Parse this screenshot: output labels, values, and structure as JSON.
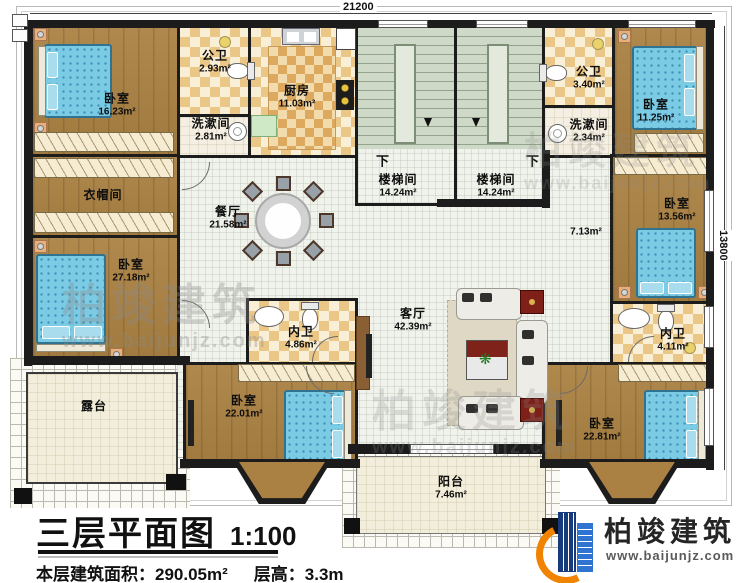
{
  "dimensions": {
    "top": "21200",
    "right": "13800"
  },
  "rooms": {
    "bedroom_tl": {
      "name": "卧室",
      "area": "16.23m²"
    },
    "pub_bath_l": {
      "name": "公卫",
      "area": "2.93m²"
    },
    "wash_l": {
      "name": "洗漱间",
      "area": "2.81m²"
    },
    "kitchen": {
      "name": "厨房",
      "area": "11.03m²"
    },
    "stair_l": {
      "name": "楼梯间",
      "area": "14.24m²",
      "down": "下"
    },
    "stair_r": {
      "name": "楼梯间",
      "area": "14.24m²",
      "down": "下"
    },
    "pub_bath_r": {
      "name": "公卫",
      "area": "3.40m²"
    },
    "wash_r": {
      "name": "洗漱间",
      "area": "2.34m²"
    },
    "bedroom_tr": {
      "name": "卧室",
      "area": "11.25m²"
    },
    "cloakroom": {
      "name": "衣帽间"
    },
    "dining": {
      "name": "餐厅",
      "area": "21.58m²"
    },
    "bedroom_mr": {
      "name": "卧室",
      "area": "13.56m²"
    },
    "hallway": {
      "area": "7.13m²"
    },
    "bedroom_ml": {
      "name": "卧室",
      "area": "27.18m²"
    },
    "bath_ml": {
      "name": "内卫",
      "area": "4.86m²"
    },
    "living": {
      "name": "客厅",
      "area": "42.39m²"
    },
    "bath_mr": {
      "name": "内卫",
      "area": "4.11m²"
    },
    "terrace": {
      "name": "露台"
    },
    "bedroom_bl": {
      "name": "卧室",
      "area": "22.01m²"
    },
    "bedroom_br": {
      "name": "卧室",
      "area": "22.81m²"
    },
    "balcony": {
      "name": "阳台",
      "area": "7.46m²"
    }
  },
  "title_block": {
    "title": "三层平面图",
    "scale": "1:100",
    "area_label": "本层建筑面积：290.05m²",
    "floor_height_label": "层高：3.3m"
  },
  "brand": {
    "name": "柏竣建筑",
    "url": "www.baijunjz.com"
  },
  "watermark": {
    "name": "柏竣建筑",
    "url": "www.baijunjz.com"
  },
  "colors": {
    "wall": "#1c1c1c",
    "wood_floor": "#aa8142",
    "tile": "#eac687",
    "stair": "#ced9c7",
    "bed": "#7ccbe4",
    "brand_blue": "#173a7c",
    "brand_orange": "#f08300"
  }
}
